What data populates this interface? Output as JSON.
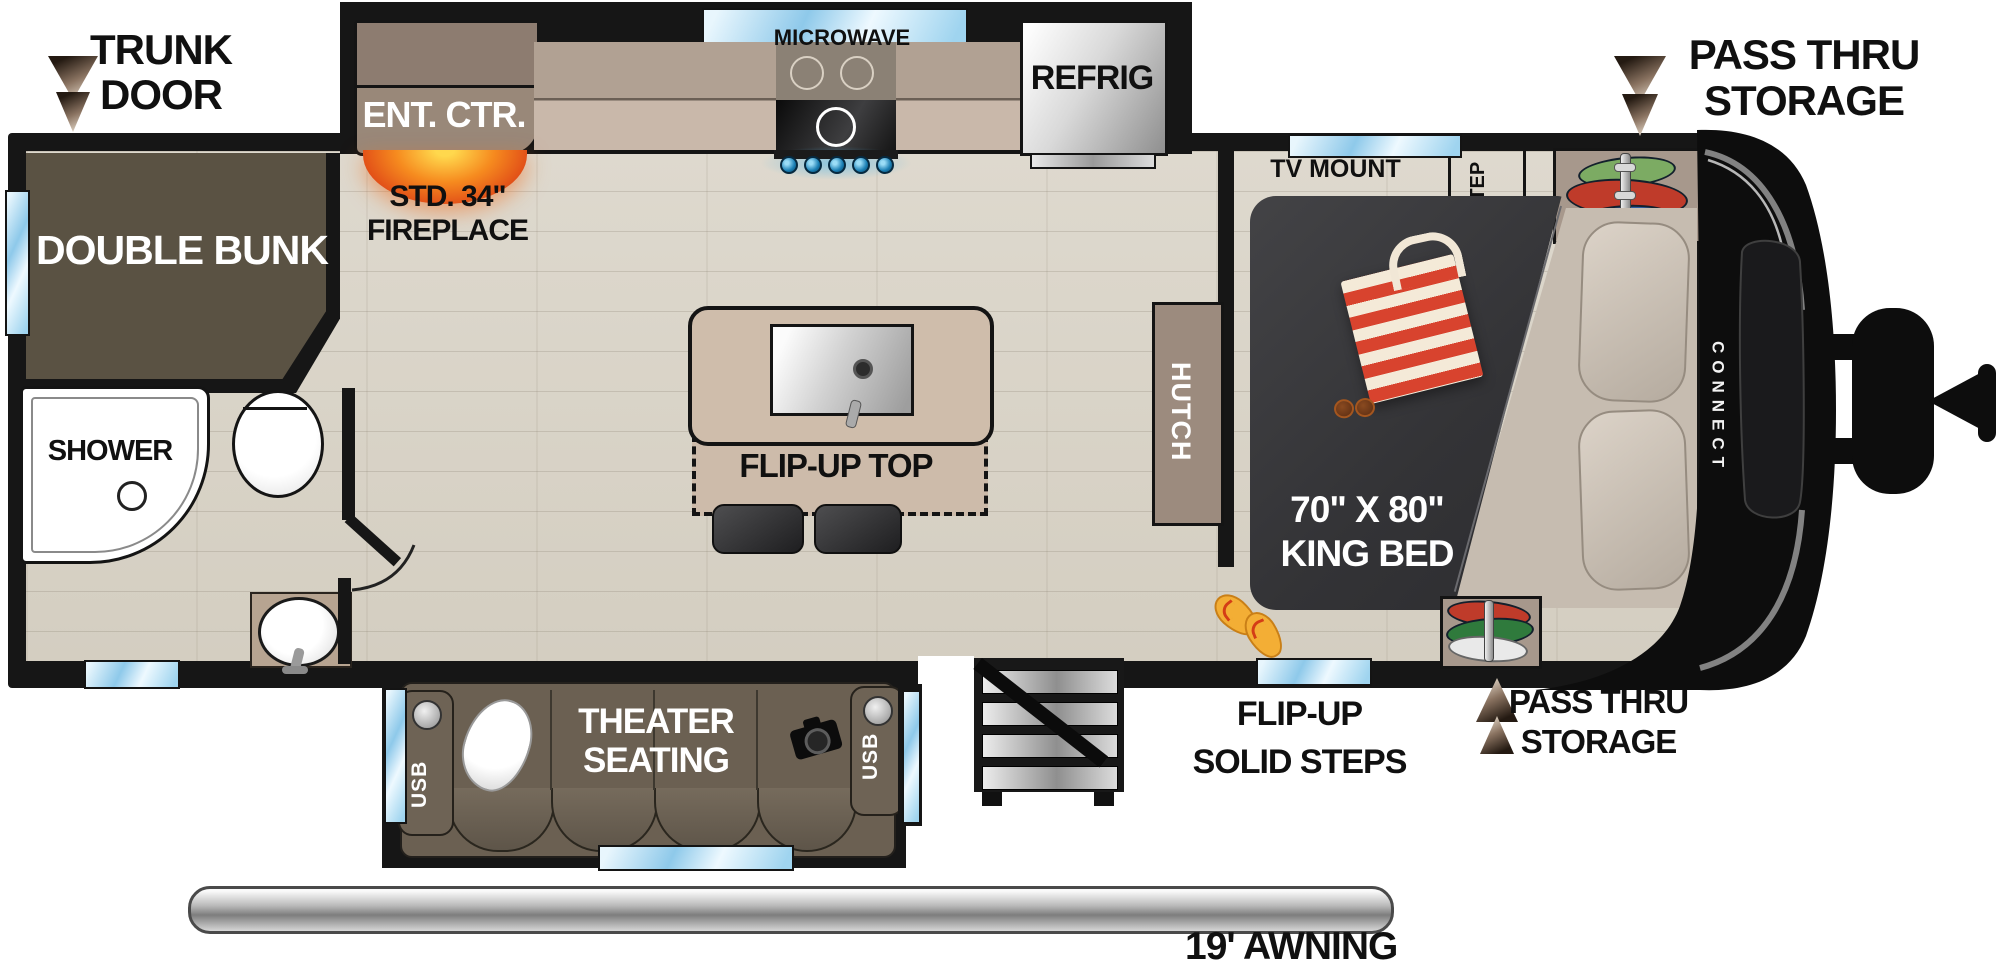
{
  "plan": {
    "brand": "CONNECT",
    "exterior": {
      "trunk_door_1": "TRUNK",
      "trunk_door_2": "DOOR",
      "pass_thru_top_1": "PASS THRU",
      "pass_thru_top_2": "STORAGE",
      "pass_thru_bottom_1": "PASS THRU",
      "pass_thru_bottom_2": "STORAGE",
      "entry_steps_1": "FLIP-UP",
      "entry_steps_2": "SOLID STEPS",
      "awning": "19' AWNING"
    },
    "kitchen": {
      "ent_ctr": "ENT. CTR.",
      "fireplace_1": "STD. 34\"",
      "fireplace_2": "FIREPLACE",
      "microwave": "MICROWAVE",
      "refrig": "REFRIG",
      "flip_up_top": "FLIP-UP TOP",
      "hutch": "HUTCH"
    },
    "bedroom": {
      "tv_mount": "TV MOUNT",
      "step": "STEP",
      "bed_size": "70\" X 80\"",
      "bed_type": "KING BED"
    },
    "rear": {
      "double_bunk": "DOUBLE BUNK",
      "shower": "SHOWER"
    },
    "living": {
      "theater_1": "THEATER",
      "theater_2": "SEATING",
      "usb_left": "USB",
      "usb_right": "USB"
    },
    "colors": {
      "wall_black": "#161616",
      "floor_tan": "#dad4c8",
      "bunk_olive": "#5a5243",
      "cabinet_tan": "#9c8b7e",
      "counter_tan": "#c9b8aa",
      "window_blue": "#8ec9ea",
      "bed_charcoal": "#3a3a3d",
      "sofa_brown": "#6b6052",
      "fireplace_orange": "#f0761f",
      "bag_red": "#d8432e",
      "knob_blue": "#1b7fb4"
    }
  }
}
